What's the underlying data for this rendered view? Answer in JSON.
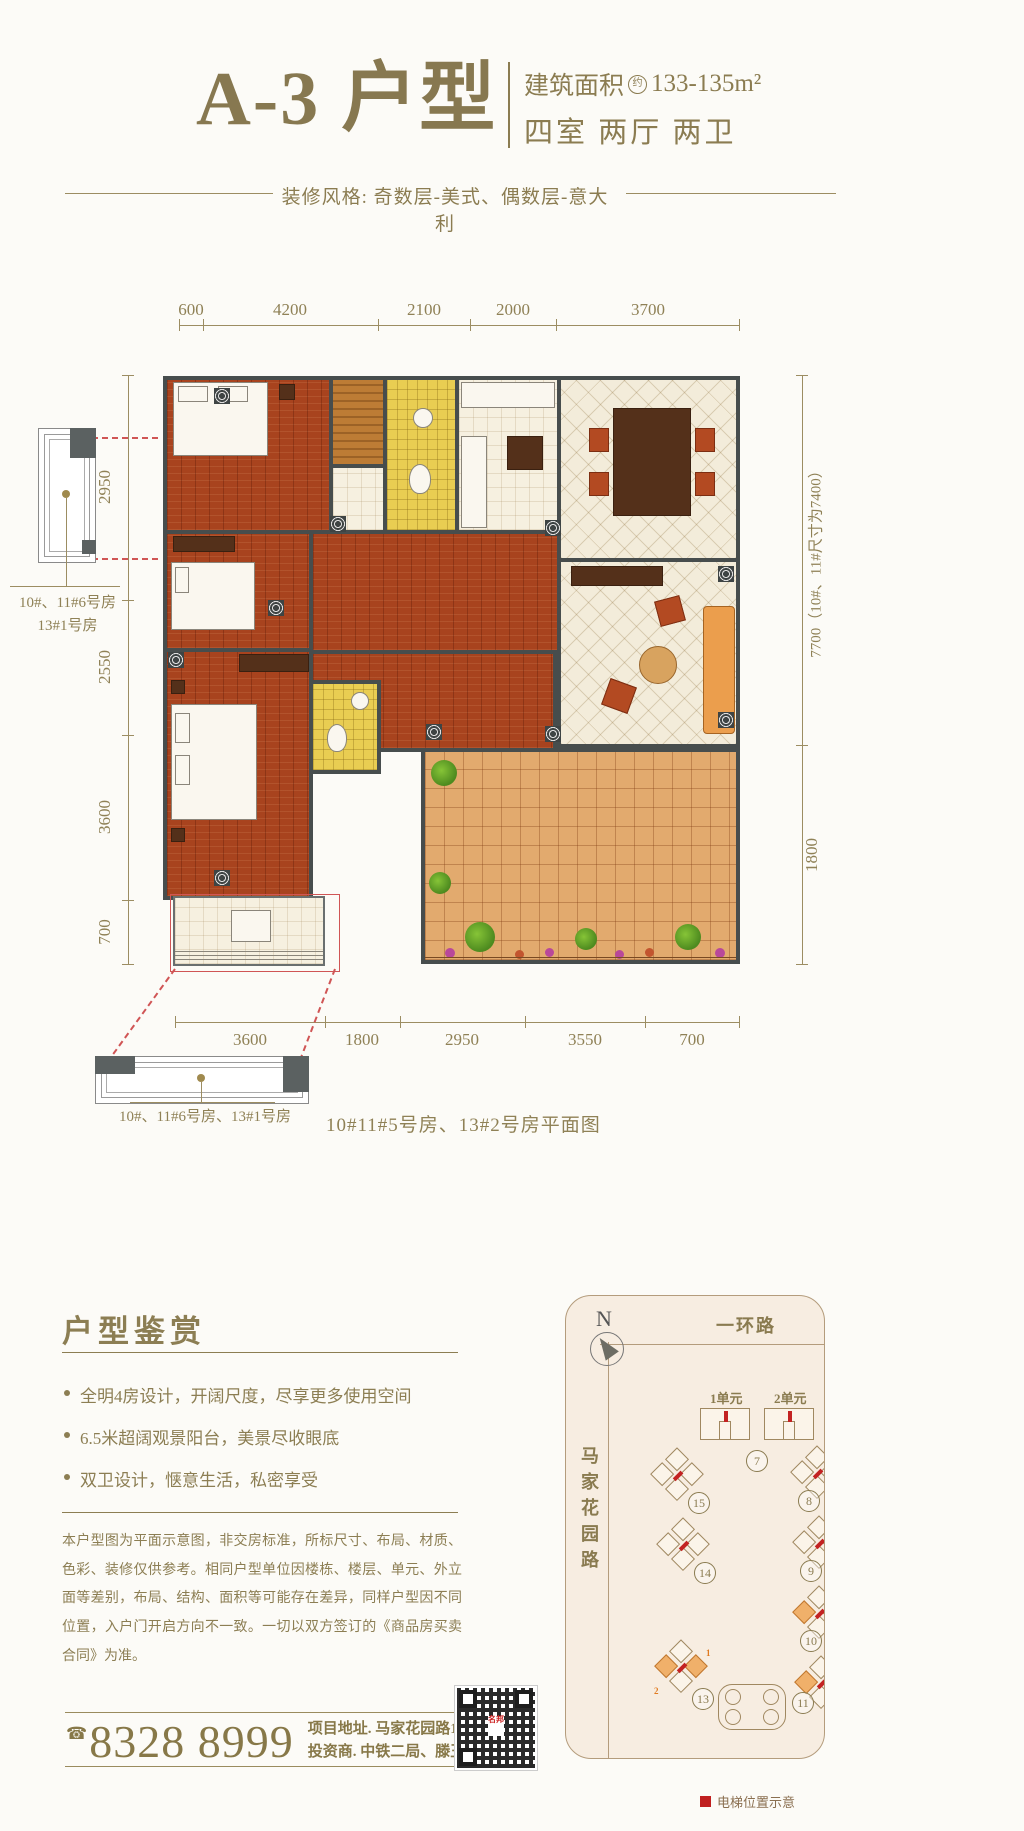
{
  "header": {
    "title": "A-3 户型",
    "area_prefix": "建筑面积",
    "area_circle": "约",
    "area_value": "133-135m²",
    "rooms": "四室 两厅 两卫",
    "style_line": "装修风格: 奇数层-美式、偶数层-意大利"
  },
  "plan": {
    "dims_top": [
      "600",
      "4200",
      "2100",
      "2000",
      "3700"
    ],
    "dims_left": [
      "2950",
      "2550",
      "3600",
      "700"
    ],
    "dim_right_main": "7700（10#、11#尺寸为7400）",
    "dim_right_sub": "1800",
    "dims_bottom": [
      "3600",
      "1800",
      "2950",
      "3550",
      "700"
    ],
    "fragment_left_label_1": "10#、11#6号房",
    "fragment_left_label_2": "13#1号房",
    "fragment_bottom_label": "10#、11#6号房、13#1号房",
    "caption": "10#11#5号房、13#2号房平面图"
  },
  "appreciation": {
    "heading": "户型鉴赏",
    "bullets": [
      "全明4房设计，开阔尺度，尽享更多使用空间",
      "6.5米超阔观景阳台，美景尽收眼底",
      "双卫设计，惬意生活，私密享受"
    ],
    "disclaimer": "本户型图为平面示意图，非交房标准，所标尺寸、布局、材质、色彩、装修仅供参考。相同户型单位因楼栋、楼层、单元、外立面等差别，布局、结构、面积等可能存在差异，同样户型因不同位置，入户门开启方向不一致。一切以双方签订的《商品房买卖合同》为准。"
  },
  "contact": {
    "phone_icon": "☎",
    "phone": "8328 8999",
    "address": "项目地址. 马家花园路16号",
    "developer": "投资商. 中铁二局、滕王阁地产"
  },
  "site_map": {
    "north": "N",
    "road_top": "一环路",
    "road_left": "马家花园路",
    "unit1": "1单元",
    "unit2": "2单元",
    "buildings": [
      "7",
      "15",
      "8",
      "14",
      "9",
      "10",
      "13",
      "11"
    ],
    "b13_units": [
      "1",
      "2"
    ],
    "legend": "电梯位置示意"
  },
  "colors": {
    "accent_gold": "#8b7c51",
    "wall": "#474d4d",
    "wood_floor": "#a8431e",
    "cream_tile": "#f3ecda",
    "yellow_tile": "#e9cd52",
    "terrace_tile": "#e2aa6e",
    "sofa_orange": "#eb9e4d",
    "elevator_red": "#c32222",
    "dash_red": "#d05555"
  }
}
